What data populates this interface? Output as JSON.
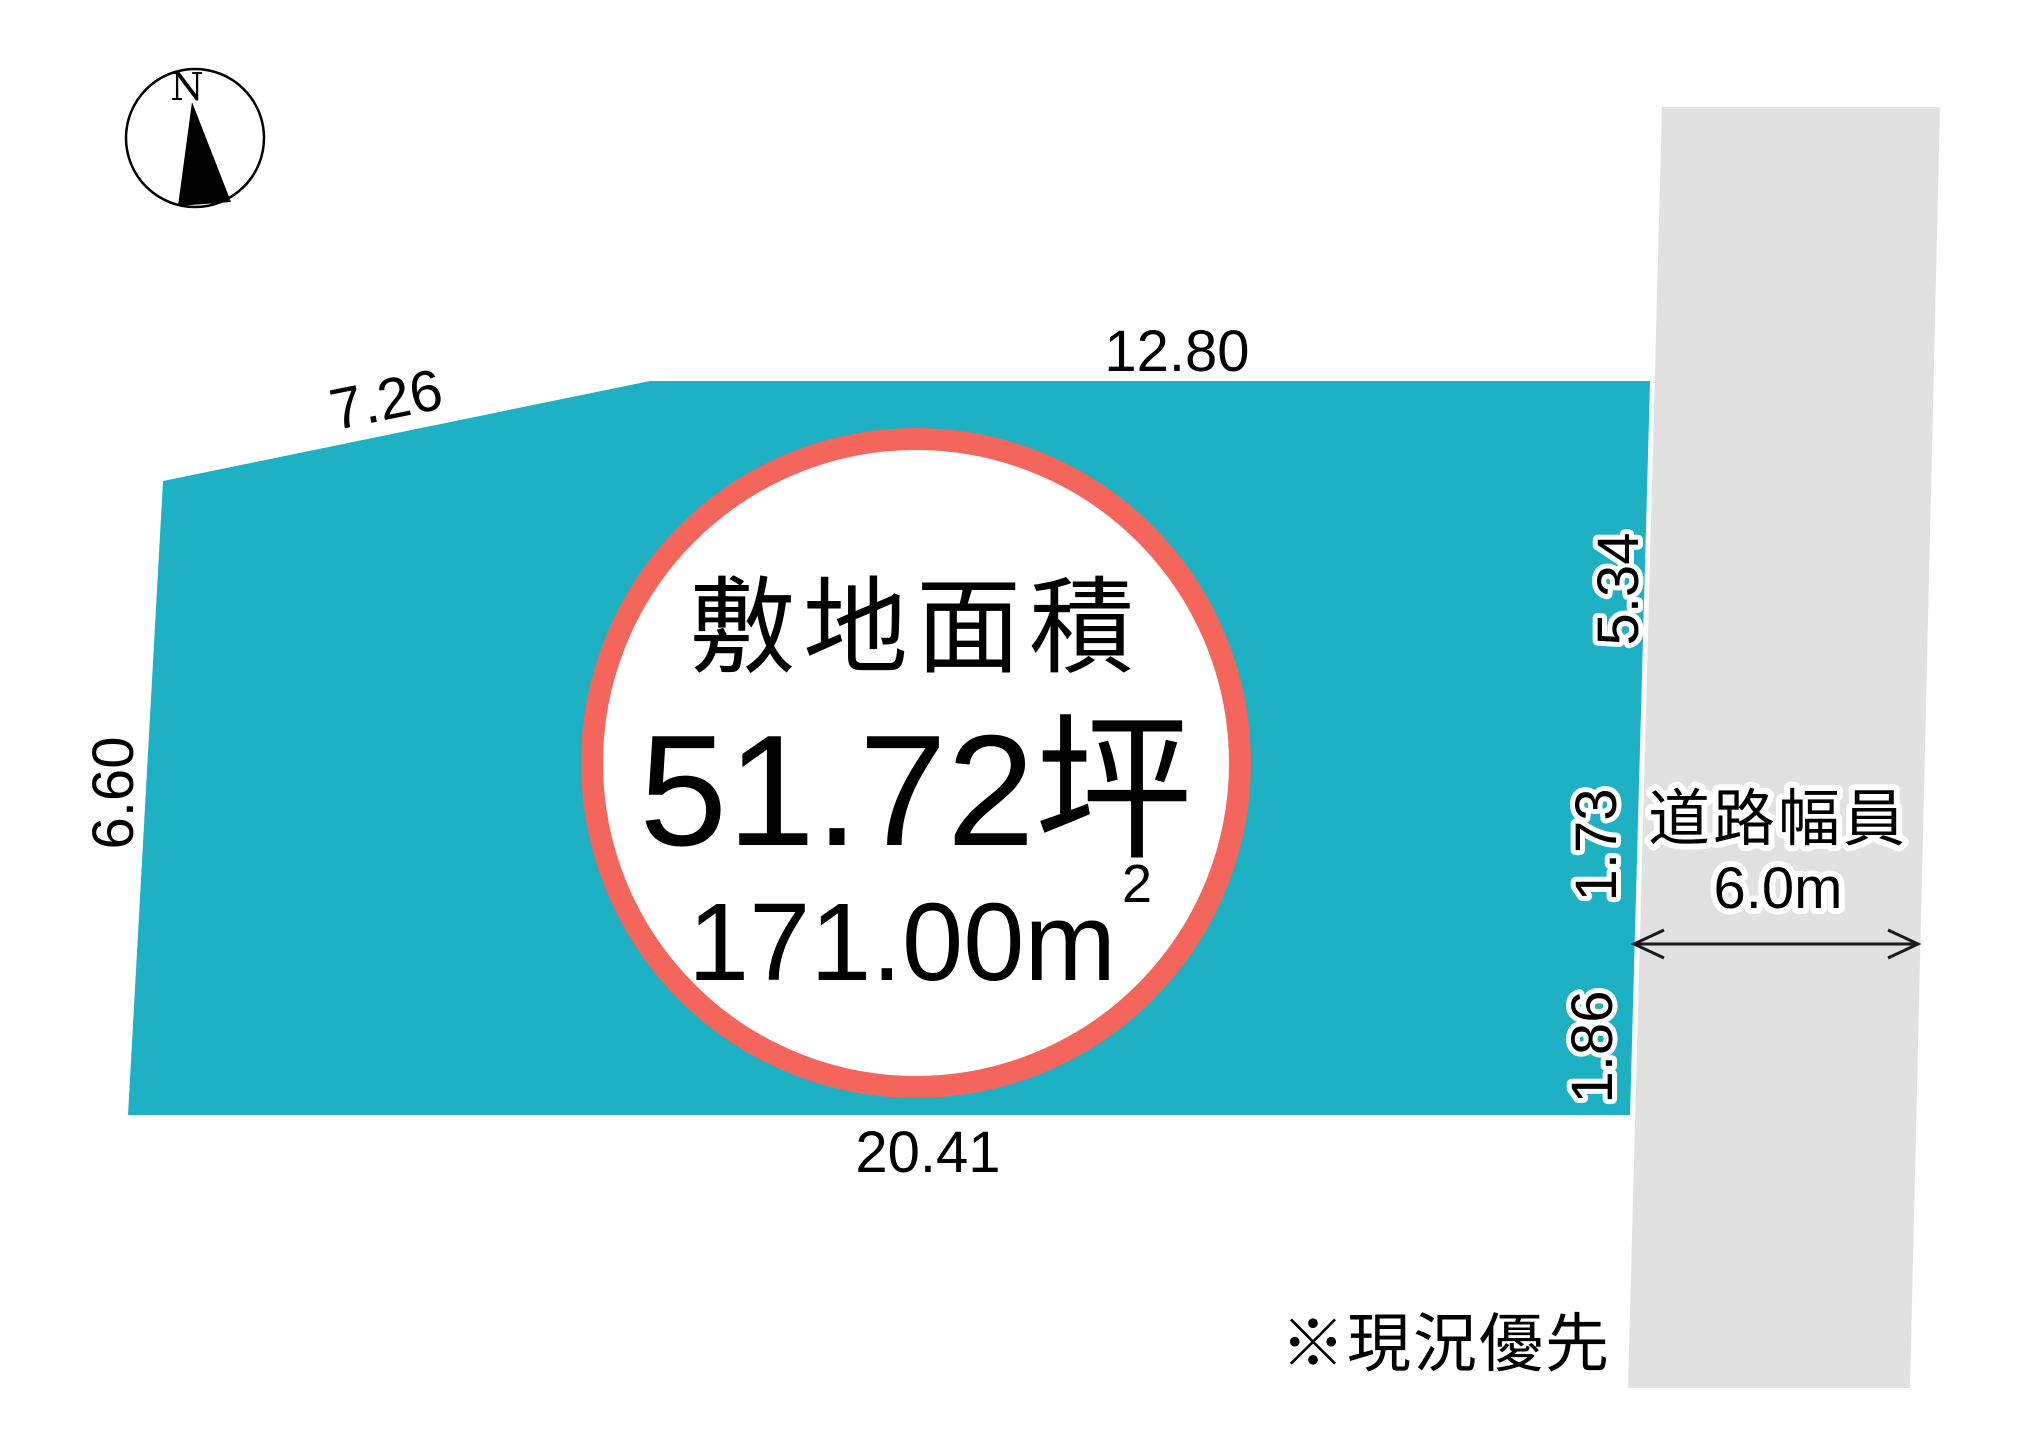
{
  "compass": {
    "north": "N"
  },
  "plot": {
    "area_label": "敷地面積",
    "area_tsubo": "51.72坪",
    "area_sqm": "171.00m",
    "area_sqm_sup": "2",
    "dim_top": "12.80",
    "dim_top_left": "7.26",
    "dim_left": "6.60",
    "dim_bottom": "20.41",
    "dim_right_upper": "5.34",
    "dim_right_mid": "1.73",
    "dim_right_lower": "1.86"
  },
  "road": {
    "label": "道路幅員",
    "width": "6.0m"
  },
  "note": "※現況優先",
  "colors": {
    "plot_fill": "#1db1c3",
    "ring": "#f4655c",
    "road_fill": "#e1e1e1",
    "ink": "#000000",
    "halo": "#ffffff"
  }
}
